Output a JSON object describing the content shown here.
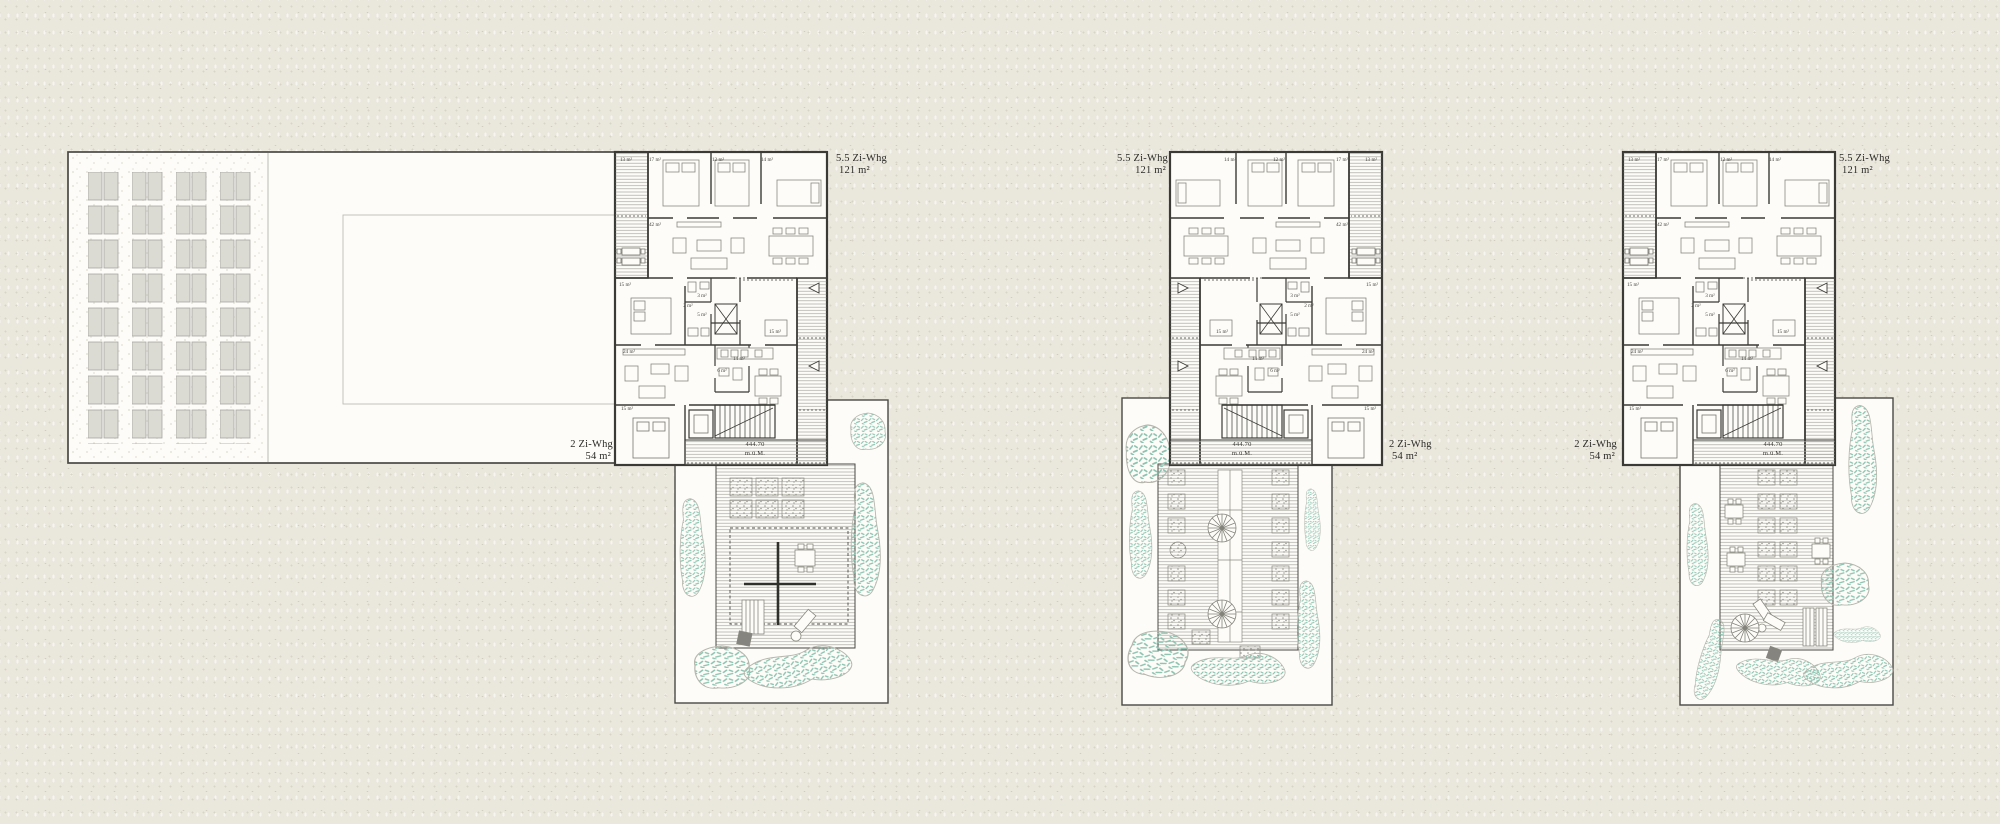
{
  "drawing": {
    "type": "architectural site plan / floor plan",
    "background_color": "#eae7dd",
    "paper_color": "#fdfcf8",
    "line_color": "#3b3a36",
    "vegetation_color": "#8cc3b0"
  },
  "apartments": {
    "large": {
      "name": "5.5 Zi-Whg",
      "area": "121 m²"
    },
    "small": {
      "name": "2 Zi-Whg",
      "area": "54 m²"
    }
  },
  "elevation": {
    "value": "444.70",
    "unit": "m.ü.M."
  },
  "rooms": {
    "balcony": "13 m²",
    "bed_a": "17 m²",
    "bed_b": "12 m²",
    "bed_c": "14 m²",
    "living_main": "42 m²",
    "bed_d": "15 m²",
    "bath_a": "3 m²",
    "wc": "2 m²",
    "bath_b": "5 m²",
    "room_e": "15 m²",
    "living_small": "24 m²",
    "kitchen": "14 m²",
    "bath_c": "6 m²",
    "bed_e": "15 m²"
  },
  "buildings": [
    {
      "label_large_side": "right",
      "label_small_side": "left"
    },
    {
      "label_large_side": "left",
      "label_small_side": "right"
    },
    {
      "label_large_side": "right",
      "label_small_side": "left"
    }
  ]
}
